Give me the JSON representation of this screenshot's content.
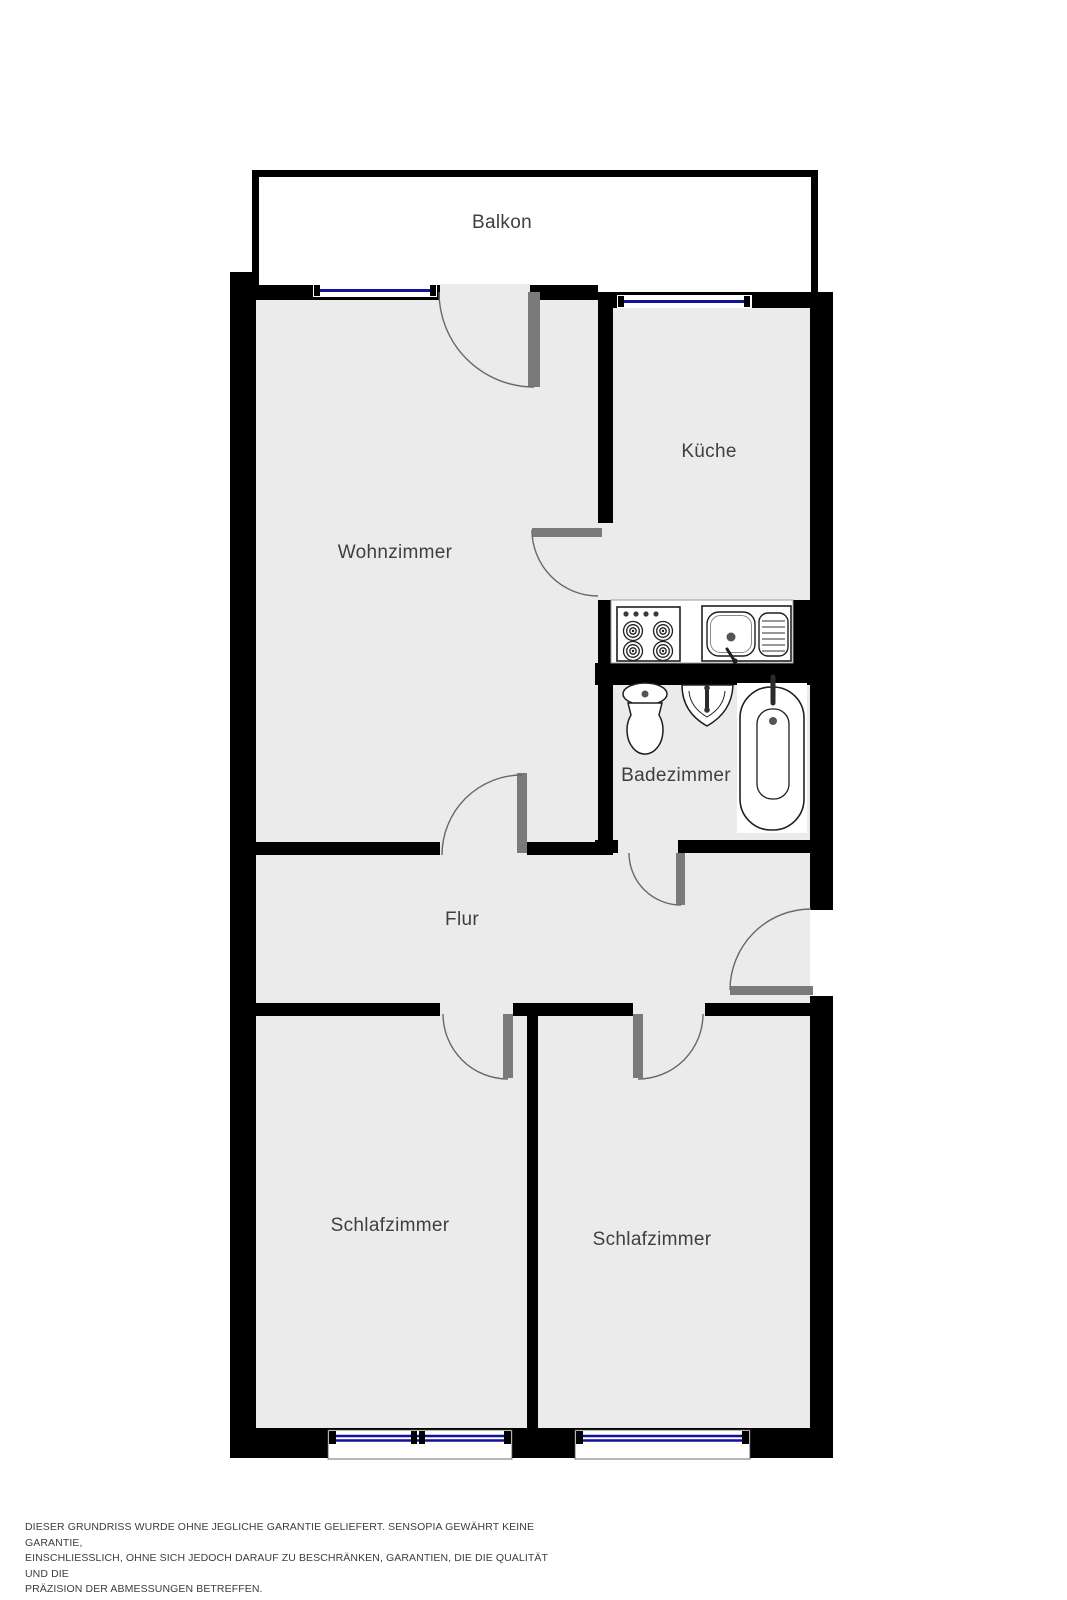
{
  "plan": {
    "rooms": {
      "balkon": {
        "label": "Balkon"
      },
      "kueche": {
        "label": "Küche"
      },
      "wohnzimmer": {
        "label": "Wohnzimmer"
      },
      "badezimmer": {
        "label": "Badezimmer"
      },
      "flur": {
        "label": "Flur"
      },
      "schlafzimmer_links": {
        "label": "Schlafzimmer"
      },
      "schlafzimmer_rechts": {
        "label": "Schlafzimmer"
      }
    },
    "fixtures": {
      "kitchen": [
        "stove-4-burner-icon",
        "kitchen-sink-drainboard-icon"
      ],
      "bathroom": [
        "toilet-icon",
        "washbasin-icon",
        "bathtub-icon"
      ]
    },
    "window_count": 4,
    "door_count": 7,
    "colors": {
      "wall": "#000000",
      "floor": "#ebebeb",
      "balcony_floor": "#ffffff",
      "window_glass": "#11119b",
      "door_leaf": "#7a7a7a",
      "door_arc": "#686868",
      "fixture_outline": "#1f1f1f",
      "label_text": "#3f3f3f"
    }
  },
  "disclaimer": {
    "lines": [
      "DIESER GRUNDRISS WURDE OHNE JEGLICHE GARANTIE GELIEFERT. SENSOPIA GEWÄHRT KEINE GARANTIE,",
      "EINSCHLIESSLICH, OHNE SICH JEDOCH DARAUF ZU BESCHRÄNKEN, GARANTIEN, DIE DIE QUALITÄT UND DIE",
      "PRÄZISION DER ABMESSUNGEN BETREFFEN."
    ]
  }
}
